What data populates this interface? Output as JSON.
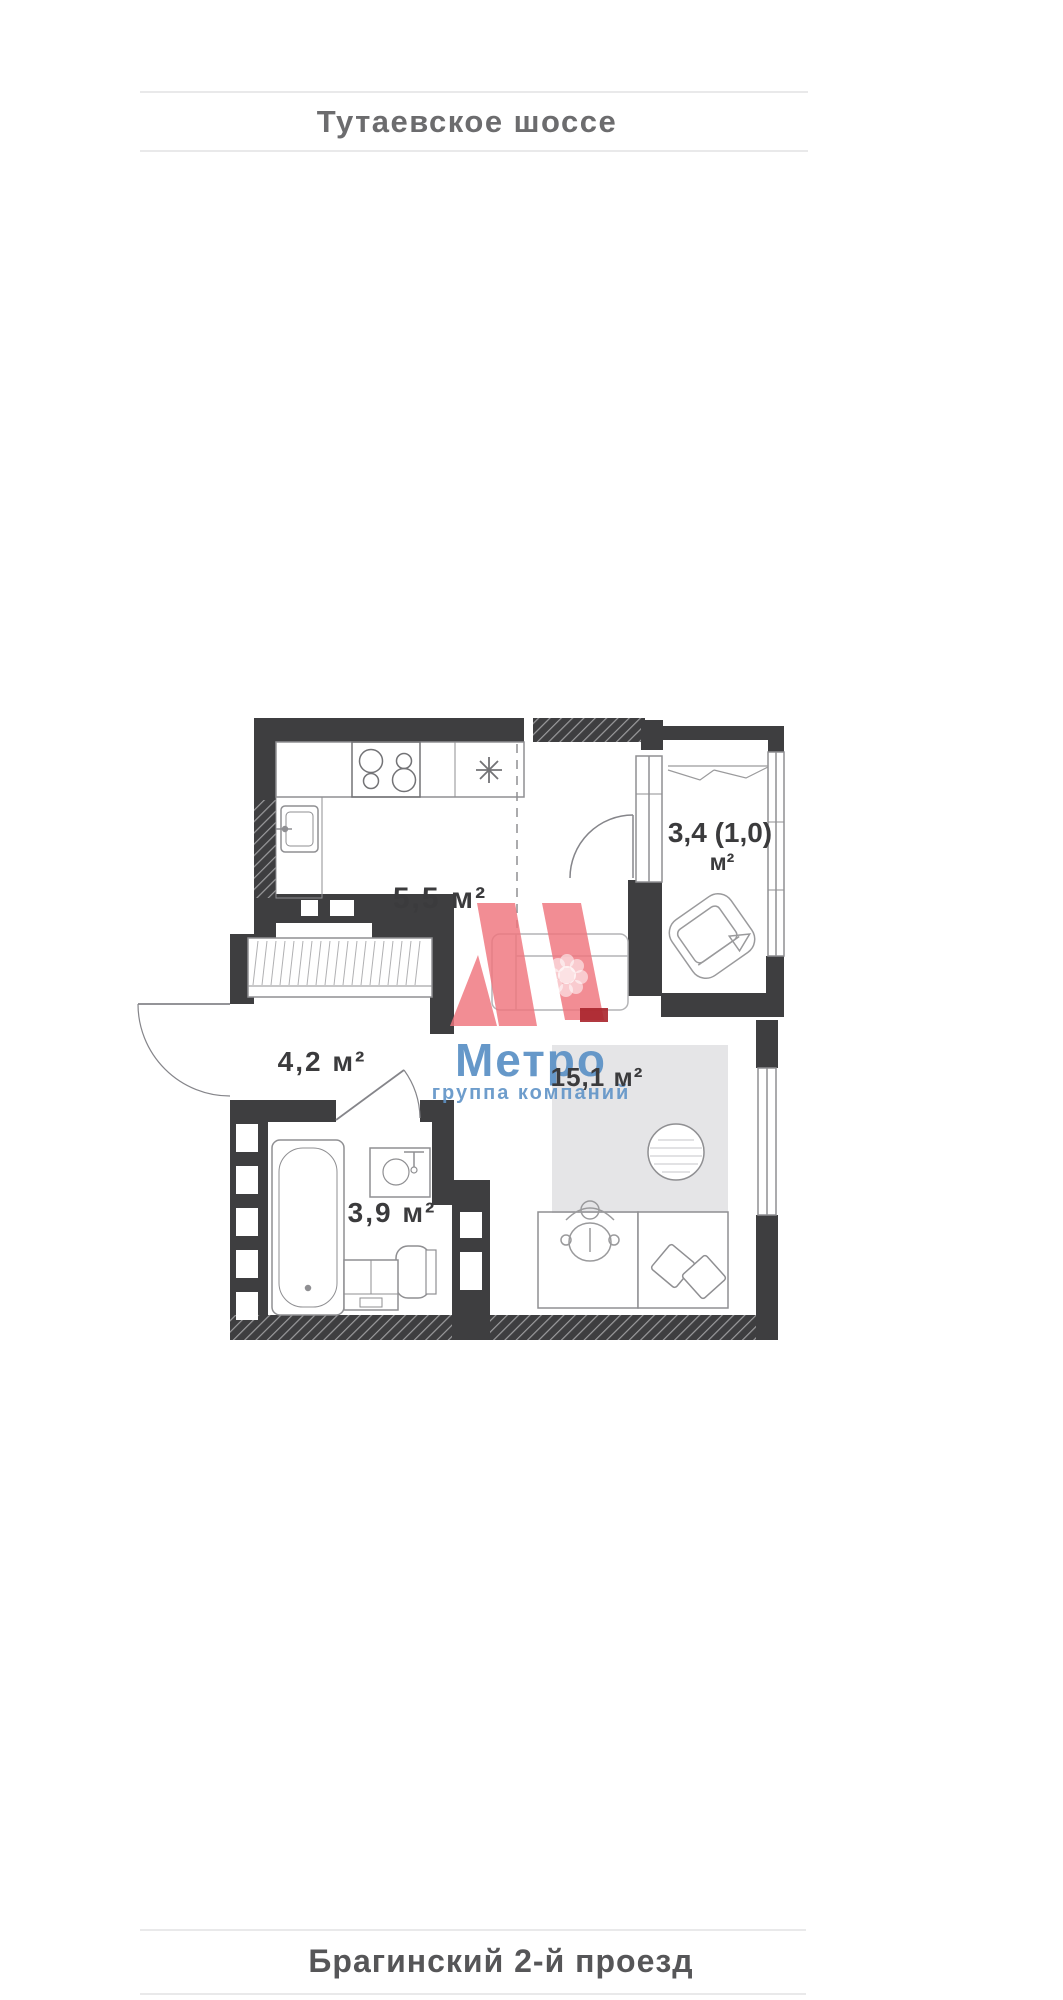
{
  "top_street": {
    "label": "Тутаевское шоссе"
  },
  "bottom_street": {
    "label": "Брагинский 2-й проезд"
  },
  "floorplan": {
    "kitchen_area": "5,5 м²",
    "balcony_area": "3,4 (1,0)",
    "balcony_area_unit": "м²",
    "hallway_area": "4,2 м²",
    "bathroom_area": "3,9 м²",
    "living_area": "15,1 м²"
  },
  "watermark": {
    "brand": "Метро",
    "tagline": "группа компаний"
  },
  "colors": {
    "wall": "#3e3e40",
    "thin_line": "#8f8f92",
    "light_line": "#b4b4b6",
    "label_text": "#3b3b3d",
    "street_top_text": "#6c6c6e",
    "street_bottom_text": "#565658",
    "rule_line": "#e9e9ea",
    "rug": "#e5e5e7",
    "logo_red": "#ef747d",
    "logo_dark_red": "#a8232b",
    "brand_blue": "#5e92c6"
  }
}
